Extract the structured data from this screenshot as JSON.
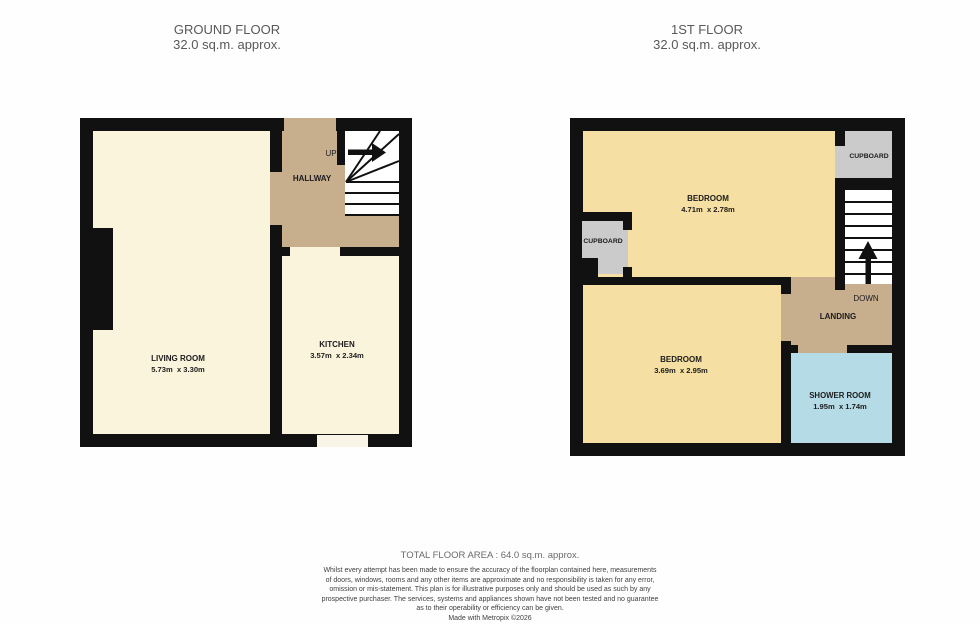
{
  "header": {
    "ground_floor": {
      "title": "GROUND FLOOR",
      "area": "32.0 sq.m. approx."
    },
    "first_floor": {
      "title": "1ST FLOOR",
      "area": "32.0 sq.m. approx."
    }
  },
  "ground_floor": {
    "hallway": {
      "name": "HALLWAY",
      "up_label": "UP"
    },
    "living_room": {
      "name": "LIVING ROOM",
      "dims": "5.73m  x 3.30m"
    },
    "kitchen": {
      "name": "KITCHEN",
      "dims": "3.57m  x 2.34m"
    }
  },
  "first_floor": {
    "bedroom1": {
      "name": "BEDROOM",
      "dims": "4.71m  x 2.78m"
    },
    "bedroom2": {
      "name": "BEDROOM",
      "dims": "3.69m  x 2.95m"
    },
    "cupboard_top": {
      "name": "CUPBOARD"
    },
    "cupboard_left": {
      "name": "CUPBOARD"
    },
    "landing": {
      "name": "LANDING",
      "down_label": "DOWN"
    },
    "shower_room": {
      "name": "SHOWER ROOM",
      "dims": "1.95m  x 1.74m"
    }
  },
  "footer": {
    "total_area": "TOTAL FLOOR AREA : 64.0 sq.m. approx.",
    "disclaimer_lines": [
      "Whilst every attempt has been made to ensure the accuracy of the floorplan contained here, measurements",
      "of doors, windows, rooms and any other items are approximate and no responsibility is taken for any error,",
      "omission or mis-statement. This plan is for illustrative purposes only and should be used as such by any",
      "prospective purchaser. The services, systems and appliances shown have not been tested and no guarantee",
      "as to their operability or efficiency can be given."
    ],
    "credit": "Made with Metropix ©2026"
  },
  "colors": {
    "wall": "#111111",
    "ground_room": "#faf4dd",
    "hallway_landing": "#c7af8e",
    "bedroom": "#f6dfa2",
    "cupboard": "#cbcbcb",
    "shower": "#b5dbe6",
    "title_text": "#59595b"
  }
}
